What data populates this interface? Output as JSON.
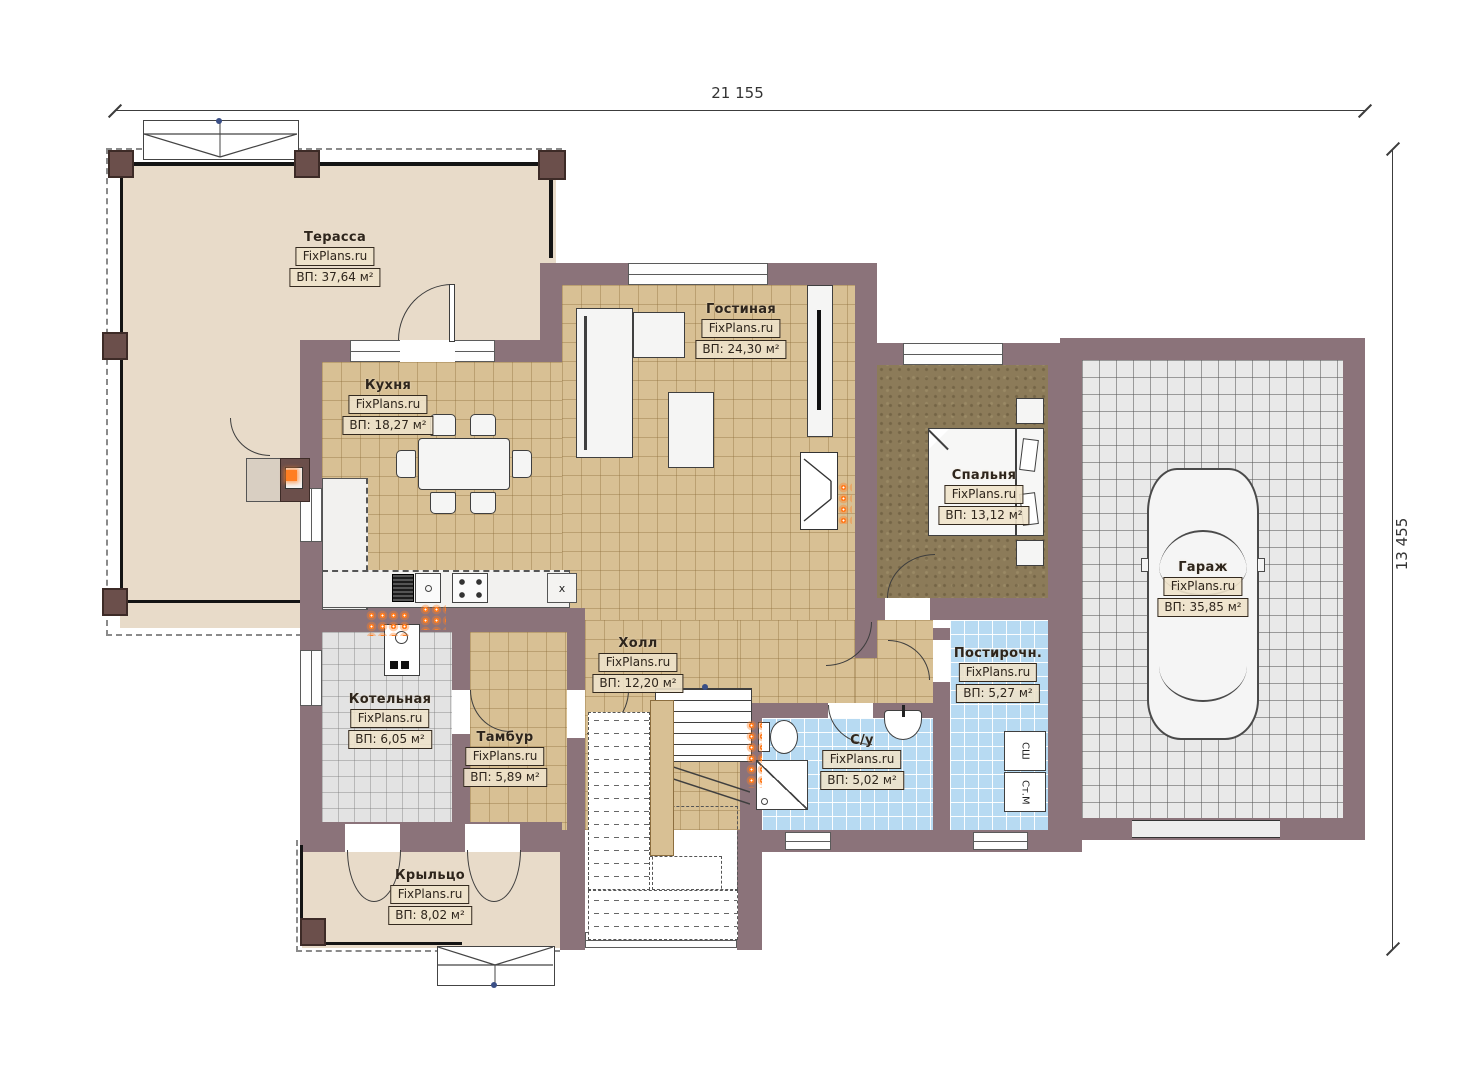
{
  "dimensions": {
    "width_total": "21 155",
    "height_total": "13 455"
  },
  "rooms": [
    {
      "key": "terrace",
      "name": "Терасса",
      "watermark": "FixPlans.ru",
      "area": "ВП: 37,64 м²"
    },
    {
      "key": "kitchen",
      "name": "Кухня",
      "watermark": "FixPlans.ru",
      "area": "ВП: 18,27 м²"
    },
    {
      "key": "living",
      "name": "Гостиная",
      "watermark": "FixPlans.ru",
      "area": "ВП: 24,30 м²"
    },
    {
      "key": "bedroom",
      "name": "Спальня",
      "watermark": "FixPlans.ru",
      "area": "ВП: 13,12 м²"
    },
    {
      "key": "garage",
      "name": "Гараж",
      "watermark": "FixPlans.ru",
      "area": "ВП: 35,85 м²"
    },
    {
      "key": "hall",
      "name": "Холл",
      "watermark": "FixPlans.ru",
      "area": "ВП: 12,20 м²"
    },
    {
      "key": "boiler",
      "name": "Котельная",
      "watermark": "FixPlans.ru",
      "area": "ВП: 6,05 м²"
    },
    {
      "key": "vestibule",
      "name": "Тамбур",
      "watermark": "FixPlans.ru",
      "area": "ВП: 5,89 м²"
    },
    {
      "key": "bathroom",
      "name": "С/у",
      "watermark": "FixPlans.ru",
      "area": "ВП: 5,02 м²"
    },
    {
      "key": "laundry",
      "name": "Постирочн.",
      "watermark": "FixPlans.ru",
      "area": "ВП: 5,27 м²"
    },
    {
      "key": "porch",
      "name": "Крыльцо",
      "watermark": "FixPlans.ru",
      "area": "ВП: 8,02 м²"
    }
  ],
  "appliances": {
    "dryer_label": "СШ",
    "washer_label": "Ст.М",
    "hood_mark": "x"
  },
  "colors": {
    "wall": "#8b737a",
    "column": "#6b4f4b",
    "floor_tan": "#d8c094",
    "floor_beige": "#e8dbc9",
    "floor_blue": "#b7daf2",
    "floor_gray_garage": "#e9e9e9",
    "floor_gray": "#e3e3e3",
    "carpet_brown": "#8c7b59",
    "radiator": "#ff7e22"
  }
}
